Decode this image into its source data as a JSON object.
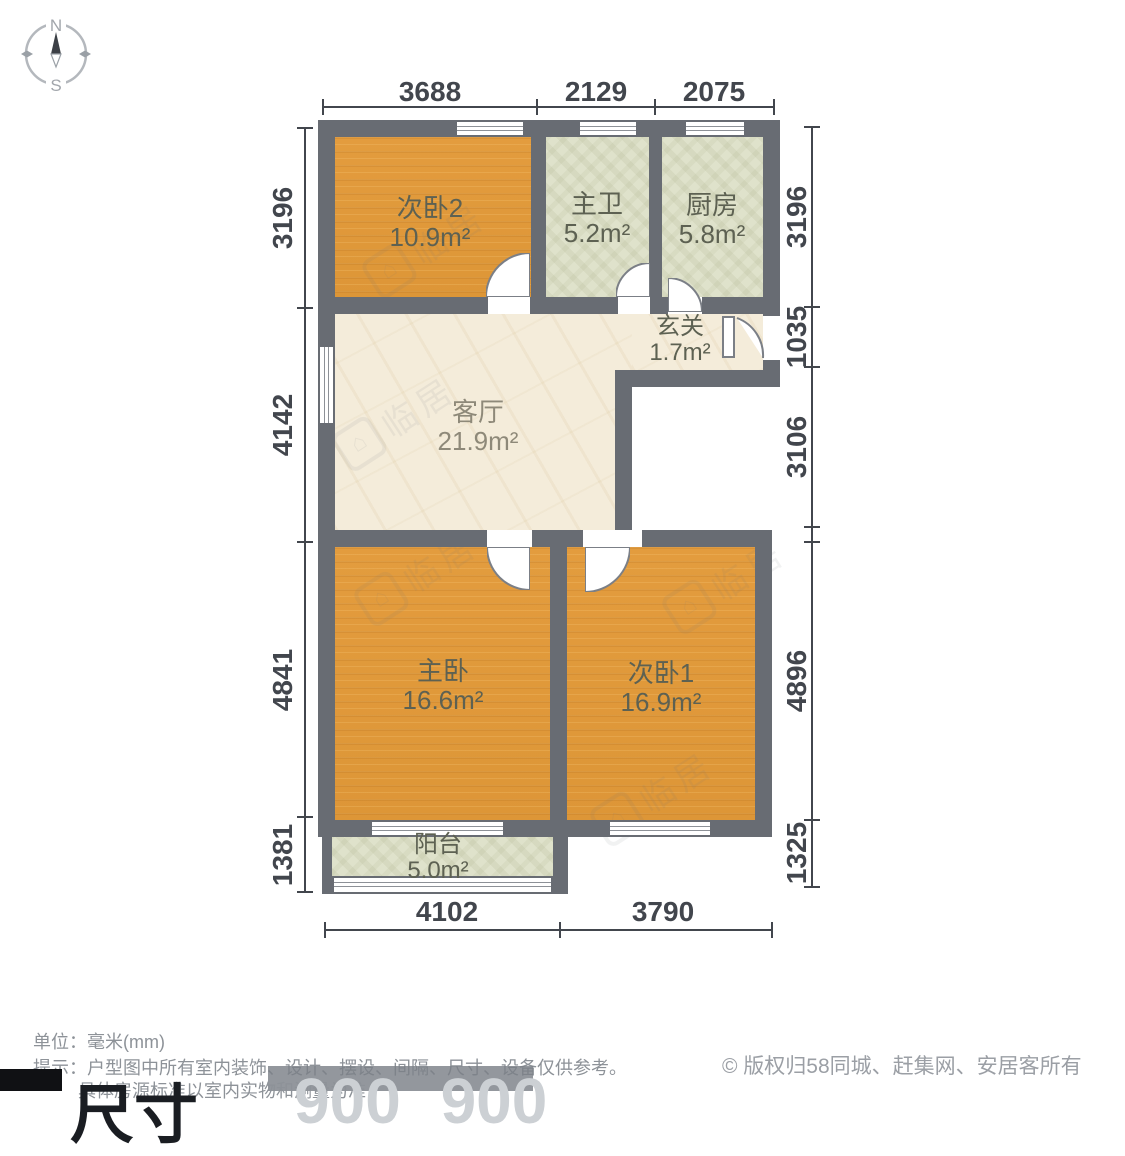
{
  "compass": {
    "north_label": "N",
    "south_label": "S"
  },
  "rooms": [
    {
      "id": "bedroom2",
      "name": "次卧2",
      "area": "10.9m²"
    },
    {
      "id": "bathroom",
      "name": "主卫",
      "area": "5.2m²"
    },
    {
      "id": "kitchen",
      "name": "厨房",
      "area": "5.8m²"
    },
    {
      "id": "entry",
      "name": "玄关",
      "area": "1.7m²"
    },
    {
      "id": "living",
      "name": "客厅",
      "area": "21.9m²"
    },
    {
      "id": "master",
      "name": "主卧",
      "area": "16.6m²"
    },
    {
      "id": "bedroom1",
      "name": "次卧1",
      "area": "16.9m²"
    },
    {
      "id": "balcony",
      "name": "阳台",
      "area": "5.0m²"
    }
  ],
  "dimensions": {
    "unit": "mm",
    "top": [
      "3688",
      "2129",
      "2075"
    ],
    "bottom": [
      "4102",
      "3790"
    ],
    "left": [
      "3196",
      "4142",
      "4841",
      "1381"
    ],
    "right": [
      "3196",
      "1035",
      "3106",
      "4896",
      "1325"
    ]
  },
  "footer": {
    "unit_line": "单位：毫米(mm)",
    "tip_line": "提示：户型图中所有室内装饰、设计、摆设、间隔、尺寸、设备仅供参考。",
    "tip_line2": "具体房源标准以室内实物和测量为准",
    "copyright": "© 版权归58同城、赶集网、安居客所有"
  },
  "overlay": {
    "label": "尺寸",
    "value": "900 900"
  },
  "watermark": {
    "text": "临居",
    "icon": "house-icon"
  },
  "colors": {
    "wall": "#686c73",
    "wood_floor": "#e19a3c",
    "tile_floor": "#dfe2cb",
    "marble_floor": "#f4ecda",
    "dimension_text": "#42464d",
    "footer_text": "#8d9298"
  }
}
